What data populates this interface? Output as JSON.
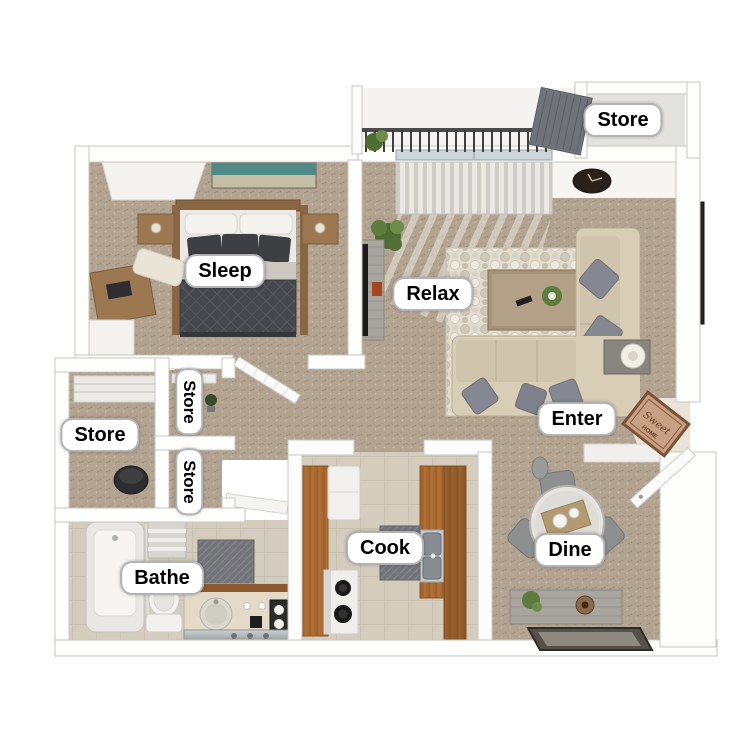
{
  "floorplan": {
    "rooms": {
      "sleep": {
        "label": "Sleep"
      },
      "relax": {
        "label": "Relax"
      },
      "enter": {
        "label": "Enter"
      },
      "dine": {
        "label": "Dine"
      },
      "cook": {
        "label": "Cook"
      },
      "bathe": {
        "label": "Bathe"
      },
      "store_left": {
        "label": "Store"
      },
      "store_closet_a": {
        "label": "Store"
      },
      "store_closet_b": {
        "label": "Store"
      },
      "store_balcony": {
        "label": "Store"
      }
    },
    "doormat": {
      "text_script": "Sweet",
      "text_caps": "HOME"
    },
    "colors": {
      "wall": "#fdfdfc",
      "wall_edge": "#c8c6c0",
      "carpet": "#b2a491",
      "tile": "#d4cdbd",
      "cabinet_wood": "#a86a31",
      "furniture_wood": "#9c7851",
      "sofa_beige": "#d8cdb5",
      "bedding_dark": "#46474c",
      "rug_light": "#e2dccf",
      "doormat_tan": "#c7a183",
      "plant_green": "#5d7c3e",
      "art_teal": "#4e8a86",
      "accent_red": "#a03828"
    }
  }
}
